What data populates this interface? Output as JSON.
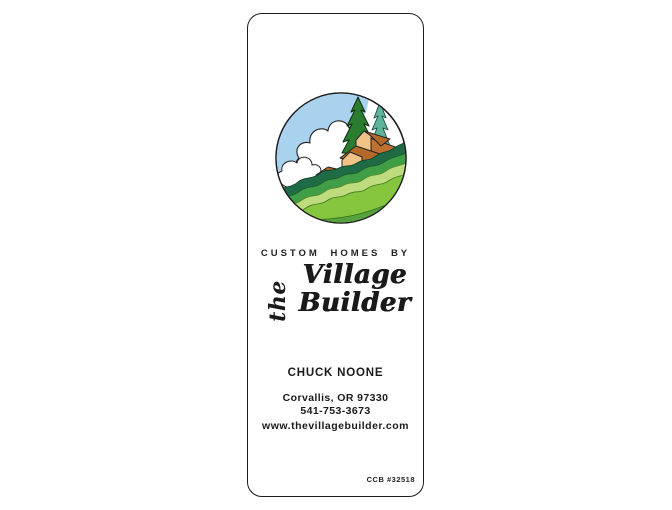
{
  "card": {
    "tagline": "CUSTOM HOMES BY",
    "brand": {
      "the": "the",
      "line1": "Village",
      "line2": "Builder"
    },
    "contact": {
      "name": "CHUCK NOONE",
      "city_state_zip": "Corvallis, OR 97330",
      "phone": "541-753-3673",
      "website": "www.thevillagebuilder.com"
    },
    "license": "CCB #32518"
  },
  "logo": {
    "name": "village-builder-logo",
    "description": "Circular illustration of stepped houses on a green hillside with pine trees, white clouds and blue sky",
    "colors": {
      "outline": "#1c1c1c",
      "sky_blue": "#a9d2ee",
      "cloud_white": "#ffffff",
      "pine_dark_green": "#2a7d2e",
      "pine_teal": "#5fb39c",
      "house_wall_tan": "#f2c386",
      "house_roof_brown": "#b4692a",
      "house_side_brown": "#c07030",
      "hill_band_colors": [
        "#1e6b46",
        "#3f9e46",
        "#bedc7d",
        "#86c53e",
        "#55a23f"
      ]
    }
  }
}
